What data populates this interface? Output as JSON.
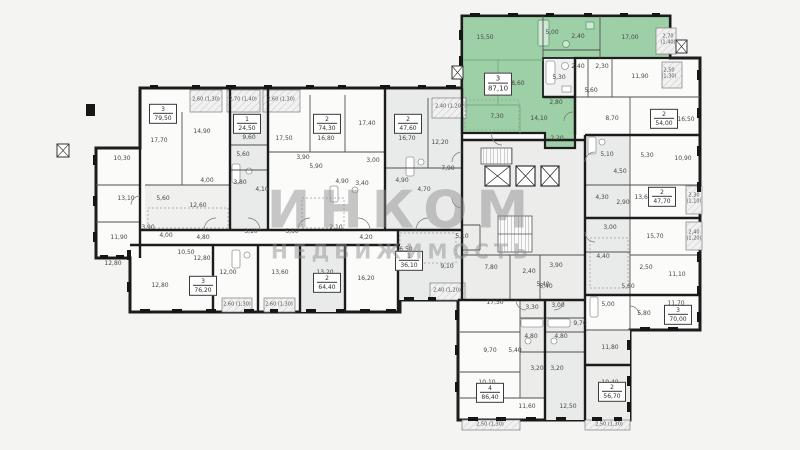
{
  "watermark": {
    "line1": "ИНКОМ",
    "line2": "НЕДВИЖИМОСТЬ"
  },
  "colors": {
    "highlight": "#9ed0a7",
    "wall": "#1c1c1c",
    "room_gray": "#e9ebea"
  },
  "units": [
    {
      "x": 163,
      "y": 114,
      "n": "3",
      "a": "79,50"
    },
    {
      "x": 247,
      "y": 124,
      "n": "1",
      "a": "24,50"
    },
    {
      "x": 327,
      "y": 124,
      "n": "2",
      "a": "74,30"
    },
    {
      "x": 408,
      "y": 124,
      "n": "2",
      "a": "47,60"
    },
    {
      "x": 498,
      "y": 84,
      "n": "3",
      "a": "87,10",
      "hl": true
    },
    {
      "x": 664,
      "y": 119,
      "n": "2",
      "a": "54,00"
    },
    {
      "x": 662,
      "y": 197,
      "n": "2",
      "a": "47,70"
    },
    {
      "x": 678,
      "y": 315,
      "n": "3",
      "a": "70,00"
    },
    {
      "x": 612,
      "y": 392,
      "n": "2",
      "a": "56,70"
    },
    {
      "x": 490,
      "y": 393,
      "n": "4",
      "a": "86,40"
    },
    {
      "x": 409,
      "y": 261,
      "n": "1",
      "a": "36,10"
    },
    {
      "x": 327,
      "y": 283,
      "n": "2",
      "a": "64,40"
    },
    {
      "x": 203,
      "y": 286,
      "n": "3",
      "a": "76,20"
    }
  ],
  "labels": [
    {
      "x": 122,
      "y": 159,
      "t": "10,30"
    },
    {
      "x": 126,
      "y": 199,
      "t": "13,10"
    },
    {
      "x": 119,
      "y": 238,
      "t": "11,90"
    },
    {
      "x": 113,
      "y": 264,
      "t": "12,80"
    },
    {
      "x": 159,
      "y": 141,
      "t": "17,70"
    },
    {
      "x": 202,
      "y": 132,
      "t": "14,90"
    },
    {
      "x": 163,
      "y": 199,
      "t": "5,60"
    },
    {
      "x": 207,
      "y": 181,
      "t": "4,00"
    },
    {
      "x": 198,
      "y": 206,
      "t": "12,60"
    },
    {
      "x": 148,
      "y": 228,
      "t": "3,90"
    },
    {
      "x": 166,
      "y": 236,
      "t": "4,00"
    },
    {
      "x": 203,
      "y": 238,
      "t": "4,80"
    },
    {
      "x": 186,
      "y": 253,
      "t": "10,50"
    },
    {
      "x": 249,
      "y": 138,
      "t": "9,60"
    },
    {
      "x": 243,
      "y": 155,
      "t": "5,60"
    },
    {
      "x": 240,
      "y": 183,
      "t": "3,80"
    },
    {
      "x": 262,
      "y": 190,
      "t": "4,10"
    },
    {
      "x": 284,
      "y": 139,
      "t": "17,50"
    },
    {
      "x": 326,
      "y": 139,
      "t": "16,80"
    },
    {
      "x": 367,
      "y": 124,
      "t": "17,40"
    },
    {
      "x": 303,
      "y": 158,
      "t": "3,90"
    },
    {
      "x": 316,
      "y": 167,
      "t": "5,90"
    },
    {
      "x": 342,
      "y": 182,
      "t": "4,90"
    },
    {
      "x": 362,
      "y": 184,
      "t": "3,40"
    },
    {
      "x": 373,
      "y": 161,
      "t": "3,00"
    },
    {
      "x": 407,
      "y": 139,
      "t": "16,70"
    },
    {
      "x": 440,
      "y": 143,
      "t": "12,20"
    },
    {
      "x": 402,
      "y": 181,
      "t": "4,90"
    },
    {
      "x": 424,
      "y": 190,
      "t": "4,70"
    },
    {
      "x": 448,
      "y": 169,
      "t": "7,90"
    },
    {
      "x": 251,
      "y": 232,
      "t": "3,10"
    },
    {
      "x": 160,
      "y": 286,
      "t": "12,80"
    },
    {
      "x": 202,
      "y": 259,
      "t": "12,80"
    },
    {
      "x": 228,
      "y": 273,
      "t": "12,00"
    },
    {
      "x": 280,
      "y": 273,
      "t": "13,60"
    },
    {
      "x": 292,
      "y": 232,
      "t": "5,60"
    },
    {
      "x": 336,
      "y": 228,
      "t": "2,10"
    },
    {
      "x": 325,
      "y": 273,
      "t": "13,20"
    },
    {
      "x": 366,
      "y": 279,
      "t": "16,20"
    },
    {
      "x": 366,
      "y": 238,
      "t": "4,20"
    },
    {
      "x": 404,
      "y": 250,
      "t": "16,50"
    },
    {
      "x": 447,
      "y": 267,
      "t": "9,10"
    },
    {
      "x": 462,
      "y": 237,
      "t": "5,10"
    },
    {
      "x": 491,
      "y": 268,
      "t": "7,80"
    },
    {
      "x": 529,
      "y": 272,
      "t": "2,40"
    },
    {
      "x": 556,
      "y": 266,
      "t": "3,90"
    },
    {
      "x": 546,
      "y": 287,
      "t": "5,40"
    },
    {
      "x": 485,
      "y": 38,
      "t": "15,50"
    },
    {
      "x": 552,
      "y": 33,
      "t": "5,00"
    },
    {
      "x": 578,
      "y": 37,
      "t": "2,40"
    },
    {
      "x": 630,
      "y": 38,
      "t": "17,00"
    },
    {
      "x": 516,
      "y": 84,
      "t": "18,60"
    },
    {
      "x": 556,
      "y": 103,
      "t": "2,80"
    },
    {
      "x": 497,
      "y": 117,
      "t": "7,30"
    },
    {
      "x": 539,
      "y": 119,
      "t": "14,10"
    },
    {
      "x": 557,
      "y": 139,
      "t": "2,20"
    },
    {
      "x": 559,
      "y": 78,
      "t": "5,30"
    },
    {
      "x": 578,
      "y": 67,
      "t": "2,40"
    },
    {
      "x": 602,
      "y": 67,
      "t": "2,30"
    },
    {
      "x": 640,
      "y": 77,
      "t": "11,90"
    },
    {
      "x": 591,
      "y": 91,
      "t": "5,60"
    },
    {
      "x": 612,
      "y": 119,
      "t": "8,70"
    },
    {
      "x": 686,
      "y": 120,
      "t": "16,50"
    },
    {
      "x": 607,
      "y": 155,
      "t": "5,10"
    },
    {
      "x": 647,
      "y": 156,
      "t": "5,30"
    },
    {
      "x": 683,
      "y": 159,
      "t": "10,90"
    },
    {
      "x": 620,
      "y": 172,
      "t": "4,50"
    },
    {
      "x": 602,
      "y": 198,
      "t": "4,30"
    },
    {
      "x": 623,
      "y": 203,
      "t": "2,90"
    },
    {
      "x": 643,
      "y": 198,
      "t": "13,60"
    },
    {
      "x": 610,
      "y": 228,
      "t": "3,00"
    },
    {
      "x": 655,
      "y": 237,
      "t": "15,70"
    },
    {
      "x": 603,
      "y": 257,
      "t": "4,40"
    },
    {
      "x": 646,
      "y": 268,
      "t": "2,50"
    },
    {
      "x": 677,
      "y": 275,
      "t": "11,10"
    },
    {
      "x": 628,
      "y": 287,
      "t": "5,60"
    },
    {
      "x": 608,
      "y": 305,
      "t": "5,00"
    },
    {
      "x": 644,
      "y": 314,
      "t": "5,80"
    },
    {
      "x": 676,
      "y": 304,
      "t": "11,70"
    },
    {
      "x": 610,
      "y": 348,
      "t": "11,80"
    },
    {
      "x": 610,
      "y": 383,
      "t": "10,40"
    },
    {
      "x": 495,
      "y": 303,
      "t": "17,50"
    },
    {
      "x": 543,
      "y": 285,
      "t": "5,40"
    },
    {
      "x": 532,
      "y": 308,
      "t": "3,30"
    },
    {
      "x": 558,
      "y": 306,
      "t": "3,00"
    },
    {
      "x": 580,
      "y": 324,
      "t": "9,70"
    },
    {
      "x": 531,
      "y": 337,
      "t": "4,80"
    },
    {
      "x": 561,
      "y": 337,
      "t": "4,80"
    },
    {
      "x": 490,
      "y": 351,
      "t": "9,70"
    },
    {
      "x": 515,
      "y": 351,
      "t": "5,40"
    },
    {
      "x": 537,
      "y": 369,
      "t": "3,20"
    },
    {
      "x": 557,
      "y": 369,
      "t": "3,20"
    },
    {
      "x": 487,
      "y": 383,
      "t": "10,10"
    },
    {
      "x": 527,
      "y": 407,
      "t": "11,60"
    },
    {
      "x": 568,
      "y": 407,
      "t": "12,50"
    },
    {
      "x": 206,
      "y": 100,
      "t": "2,60 (1,30)",
      "k": "b"
    },
    {
      "x": 243,
      "y": 100,
      "t": "2,70 (1,40)",
      "k": "b"
    },
    {
      "x": 281,
      "y": 100,
      "t": "2,60 (1,30)",
      "k": "b"
    },
    {
      "x": 449,
      "y": 107,
      "t": "2,40 (1,20)",
      "k": "b"
    },
    {
      "x": 237,
      "y": 305,
      "t": "2,60 (1,30)",
      "k": "b"
    },
    {
      "x": 279,
      "y": 305,
      "t": "2,60 (1,30)",
      "k": "b"
    },
    {
      "x": 447,
      "y": 291,
      "t": "2,40 (1,20)",
      "k": "b"
    },
    {
      "x": 490,
      "y": 425,
      "t": "2,50 (1,30)",
      "k": "b"
    },
    {
      "x": 609,
      "y": 425,
      "t": "2,50 (1,30)",
      "k": "b"
    },
    {
      "x": 668,
      "y": 40,
      "t": "2,70|(1,40)",
      "k": "b2"
    },
    {
      "x": 669,
      "y": 74,
      "t": "2,50|(1,30)",
      "k": "b2"
    },
    {
      "x": 694,
      "y": 199,
      "t": "2,30|(1,10)",
      "k": "b2"
    },
    {
      "x": 694,
      "y": 236,
      "t": "2,40|(1,20)",
      "k": "b2"
    }
  ]
}
